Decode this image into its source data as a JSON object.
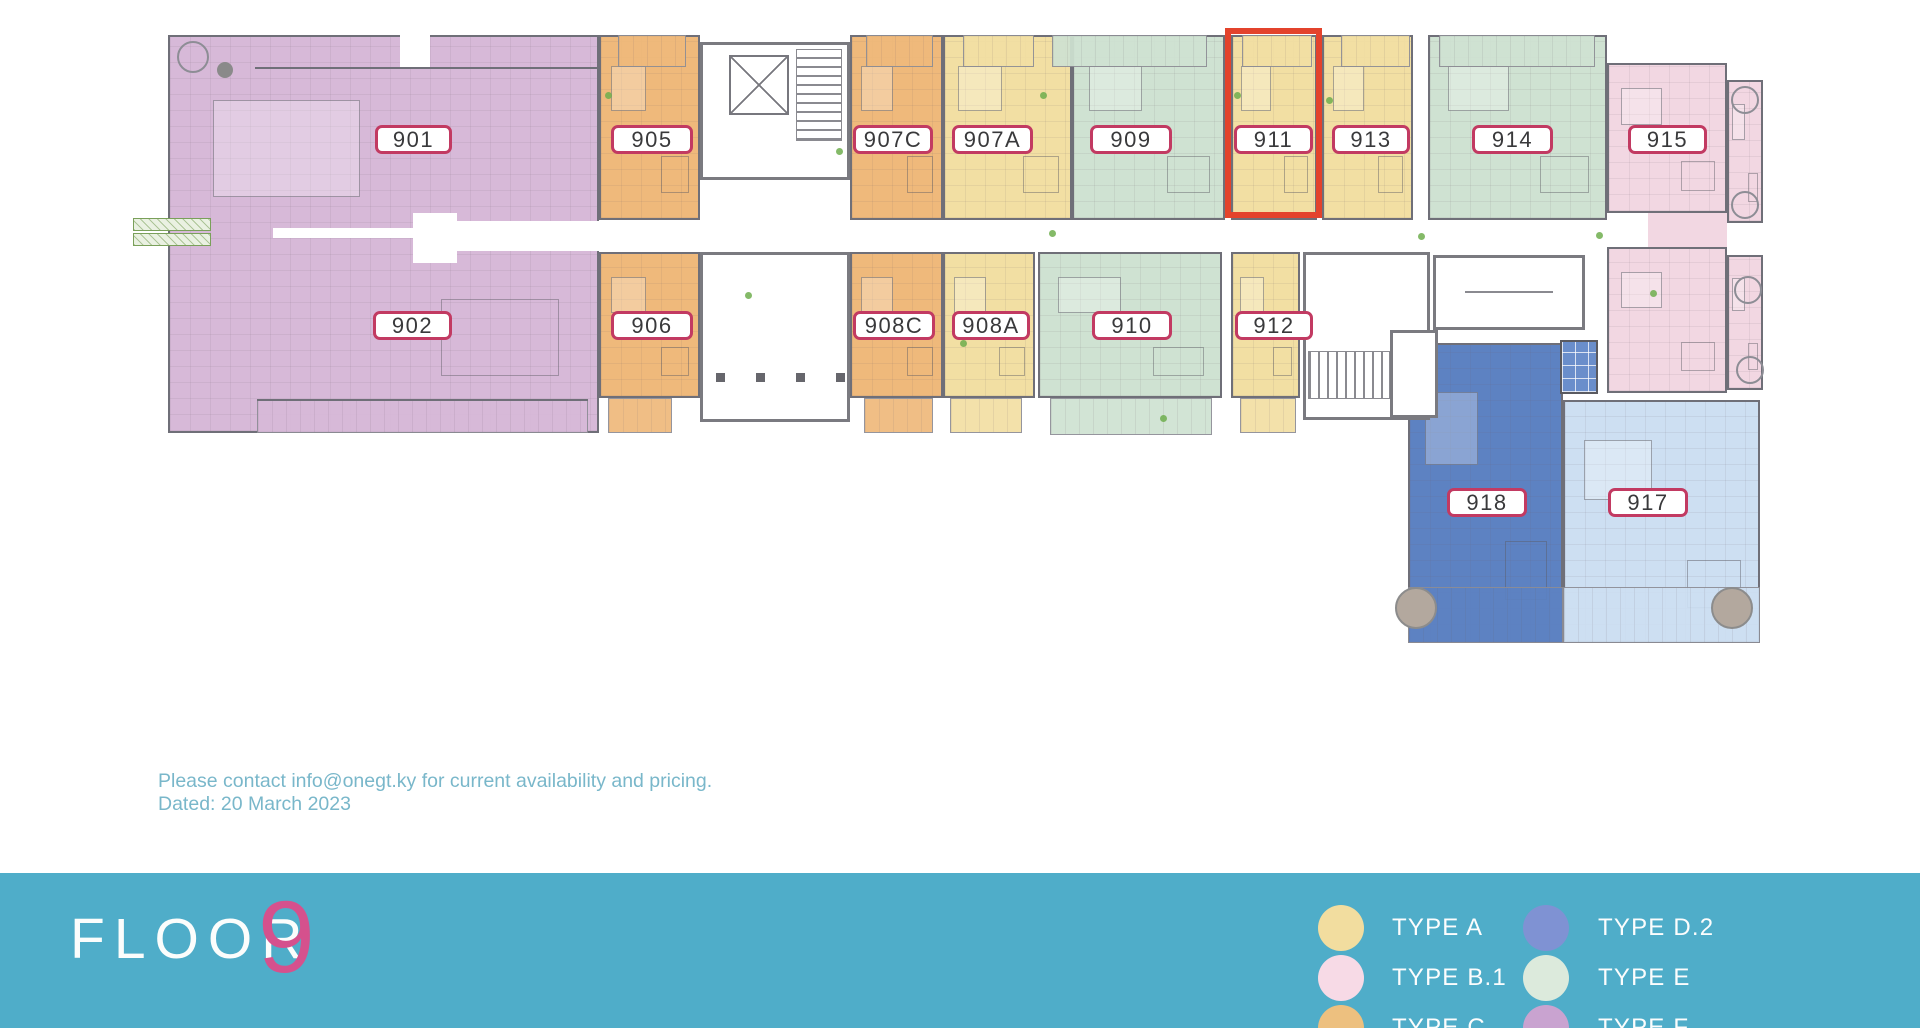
{
  "page": {
    "width": 1920,
    "height": 1028
  },
  "colors": {
    "purple": "#d7b9d8",
    "orange": "#efb97b",
    "yellow": "#f2dfa3",
    "mint": "#cfe2d2",
    "pink": "#f2d7e2",
    "blue": "#5d82c2",
    "lightblue": "#cddff2",
    "white": "#ffffff",
    "highlight_red": "#e3432c",
    "label_border": "#c23a62",
    "label_text": "#39393b",
    "footer_teal": "#4fadc9",
    "notice_teal": "#79b7ca",
    "logo_pink": "#d5518d"
  },
  "plan": {
    "highlighted_unit": "911",
    "units": [
      {
        "id": "901-902",
        "color": "purple",
        "x": 168,
        "y": 35,
        "w": 431,
        "h": 398
      },
      {
        "id": "905",
        "color": "orange",
        "x": 599,
        "y": 35,
        "w": 101,
        "h": 185
      },
      {
        "id": "907C",
        "color": "orange",
        "x": 850,
        "y": 35,
        "w": 93,
        "h": 185
      },
      {
        "id": "907A",
        "color": "yellow",
        "x": 943,
        "y": 35,
        "w": 129,
        "h": 185
      },
      {
        "id": "909",
        "color": "mint",
        "x": 1072,
        "y": 35,
        "w": 153,
        "h": 185
      },
      {
        "id": "911",
        "color": "yellow",
        "x": 1231,
        "y": 35,
        "w": 86,
        "h": 185
      },
      {
        "id": "913",
        "color": "yellow",
        "x": 1322,
        "y": 35,
        "w": 91,
        "h": 185
      },
      {
        "id": "914",
        "color": "mint",
        "x": 1428,
        "y": 35,
        "w": 179,
        "h": 185
      },
      {
        "id": "915",
        "color": "pink",
        "x": 1607,
        "y": 63,
        "w": 120,
        "h": 150
      },
      {
        "id": "915-balcony",
        "color": "pink",
        "x": 1727,
        "y": 80,
        "w": 36,
        "h": 143
      },
      {
        "id": "906",
        "color": "orange",
        "x": 599,
        "y": 252,
        "w": 101,
        "h": 146
      },
      {
        "id": "908C",
        "color": "orange",
        "x": 850,
        "y": 252,
        "w": 93,
        "h": 146
      },
      {
        "id": "908A",
        "color": "yellow",
        "x": 943,
        "y": 252,
        "w": 92,
        "h": 146
      },
      {
        "id": "910",
        "color": "mint",
        "x": 1038,
        "y": 252,
        "w": 184,
        "h": 146
      },
      {
        "id": "912",
        "color": "yellow",
        "x": 1231,
        "y": 252,
        "w": 69,
        "h": 146
      },
      {
        "id": "916",
        "color": "pink",
        "x": 1607,
        "y": 247,
        "w": 120,
        "h": 146
      },
      {
        "id": "916-balcony",
        "color": "pink",
        "x": 1727,
        "y": 255,
        "w": 36,
        "h": 135
      },
      {
        "id": "918",
        "color": "blue",
        "x": 1408,
        "y": 343,
        "w": 155,
        "h": 300
      },
      {
        "id": "917",
        "color": "lightblue",
        "x": 1563,
        "y": 400,
        "w": 197,
        "h": 243
      }
    ],
    "balconies": [
      {
        "of": "905",
        "color": "orange",
        "x": 618,
        "y": 35,
        "w": 68,
        "h": 32
      },
      {
        "of": "907C",
        "color": "orange",
        "x": 866,
        "y": 35,
        "w": 67,
        "h": 32
      },
      {
        "of": "907A",
        "color": "yellow",
        "x": 963,
        "y": 35,
        "w": 71,
        "h": 32
      },
      {
        "of": "909",
        "color": "mint",
        "x": 1052,
        "y": 35,
        "w": 155,
        "h": 32
      },
      {
        "of": "911",
        "color": "yellow",
        "x": 1242,
        "y": 35,
        "w": 70,
        "h": 32
      },
      {
        "of": "913",
        "color": "yellow",
        "x": 1341,
        "y": 35,
        "w": 69,
        "h": 32
      },
      {
        "of": "914",
        "color": "mint",
        "x": 1439,
        "y": 35,
        "w": 156,
        "h": 32
      },
      {
        "of": "902",
        "color": "purple",
        "x": 257,
        "y": 400,
        "w": 331,
        "h": 33
      },
      {
        "of": "906",
        "color": "orange",
        "x": 608,
        "y": 398,
        "w": 64,
        "h": 35
      },
      {
        "of": "908C",
        "color": "orange",
        "x": 864,
        "y": 398,
        "w": 69,
        "h": 35
      },
      {
        "of": "908A",
        "color": "yellow",
        "x": 950,
        "y": 398,
        "w": 72,
        "h": 35
      },
      {
        "of": "910",
        "color": "mint",
        "x": 1050,
        "y": 398,
        "w": 162,
        "h": 37
      },
      {
        "of": "912",
        "color": "yellow",
        "x": 1240,
        "y": 398,
        "w": 56,
        "h": 35
      },
      {
        "of": "917-918",
        "color": "blue",
        "x": 1408,
        "y": 587,
        "w": 155,
        "h": 56
      },
      {
        "of": "917",
        "color": "lightblue",
        "x": 1563,
        "y": 587,
        "w": 197,
        "h": 56
      }
    ],
    "corridor": [
      {
        "x": 273,
        "y": 228,
        "w": 140,
        "h": 10,
        "color": "white"
      },
      {
        "x": 413,
        "y": 213,
        "w": 44,
        "h": 50,
        "color": "white"
      },
      {
        "x": 450,
        "y": 221,
        "w": 149,
        "h": 30,
        "color": "white"
      },
      {
        "x": 400,
        "y": 35,
        "w": 30,
        "h": 33,
        "color": "white"
      },
      {
        "x": 1648,
        "y": 213,
        "w": 79,
        "h": 34,
        "color": "pink"
      }
    ],
    "lines": [
      {
        "x": 255,
        "y": 67,
        "w": 344
      },
      {
        "x": 257,
        "y": 399,
        "w": 331
      }
    ],
    "service_areas": [
      {
        "kind": "stair-elevator-core",
        "x": 700,
        "y": 42,
        "w": 150,
        "h": 138
      },
      {
        "kind": "lobby",
        "x": 700,
        "y": 252,
        "w": 150,
        "h": 170
      },
      {
        "kind": "stairwell",
        "x": 1303,
        "y": 252,
        "w": 127,
        "h": 168
      },
      {
        "kind": "amenity-room",
        "x": 1433,
        "y": 255,
        "w": 152,
        "h": 75
      },
      {
        "kind": "hall",
        "x": 1390,
        "y": 330,
        "w": 48,
        "h": 88
      },
      {
        "kind": "pool",
        "x": 1560,
        "y": 340,
        "w": 38,
        "h": 54
      }
    ],
    "planters": [
      {
        "x": 133,
        "y": 218,
        "w": 78,
        "h": 13
      },
      {
        "x": 133,
        "y": 233,
        "w": 78,
        "h": 13
      }
    ],
    "circles": [
      {
        "x": 193,
        "y": 57,
        "r": 16,
        "stroke": "#8d8d95"
      },
      {
        "x": 225,
        "y": 70,
        "r": 8,
        "fill": "#8a8a8a"
      },
      {
        "x": 1745,
        "y": 100,
        "r": 14,
        "stroke": "#8d8d95"
      },
      {
        "x": 1745,
        "y": 205,
        "r": 14,
        "stroke": "#8d8d95"
      },
      {
        "x": 1748,
        "y": 290,
        "r": 14,
        "stroke": "#8d8d95"
      },
      {
        "x": 1750,
        "y": 370,
        "r": 14,
        "stroke": "#8d8d95"
      },
      {
        "x": 1416,
        "y": 608,
        "r": 21,
        "fill": "#b3a89e",
        "stroke": "#8c8c8c"
      },
      {
        "x": 1732,
        "y": 608,
        "r": 21,
        "fill": "#b3a89e",
        "stroke": "#8c8c8c"
      }
    ],
    "plants": [
      {
        "x": 605,
        "y": 92
      },
      {
        "x": 836,
        "y": 148
      },
      {
        "x": 1040,
        "y": 92
      },
      {
        "x": 1049,
        "y": 230
      },
      {
        "x": 1234,
        "y": 92
      },
      {
        "x": 1326,
        "y": 97
      },
      {
        "x": 1418,
        "y": 233
      },
      {
        "x": 1596,
        "y": 232
      },
      {
        "x": 1650,
        "y": 290
      },
      {
        "x": 1160,
        "y": 415
      },
      {
        "x": 745,
        "y": 292
      },
      {
        "x": 960,
        "y": 340
      }
    ],
    "highlight": {
      "x": 1225,
      "y": 28,
      "w": 97,
      "h": 190
    },
    "labels": [
      {
        "text": "901",
        "x": 375,
        "y": 125,
        "w": 77
      },
      {
        "text": "905",
        "x": 611,
        "y": 125,
        "w": 82
      },
      {
        "text": "907C",
        "x": 853,
        "y": 125,
        "w": 80
      },
      {
        "text": "907A",
        "x": 952,
        "y": 125,
        "w": 81
      },
      {
        "text": "909",
        "x": 1090,
        "y": 125,
        "w": 82
      },
      {
        "text": "911",
        "x": 1234,
        "y": 125,
        "w": 79
      },
      {
        "text": "913",
        "x": 1332,
        "y": 125,
        "w": 78
      },
      {
        "text": "914",
        "x": 1472,
        "y": 125,
        "w": 81
      },
      {
        "text": "915",
        "x": 1628,
        "y": 125,
        "w": 79
      },
      {
        "text": "902",
        "x": 373,
        "y": 311,
        "w": 79
      },
      {
        "text": "906",
        "x": 611,
        "y": 311,
        "w": 82
      },
      {
        "text": "908C",
        "x": 853,
        "y": 311,
        "w": 82
      },
      {
        "text": "908A",
        "x": 952,
        "y": 311,
        "w": 78
      },
      {
        "text": "910",
        "x": 1092,
        "y": 311,
        "w": 80
      },
      {
        "text": "912",
        "x": 1235,
        "y": 311,
        "w": 78
      },
      {
        "text": "918",
        "x": 1447,
        "y": 488,
        "w": 80
      },
      {
        "text": "917",
        "x": 1608,
        "y": 488,
        "w": 80
      }
    ]
  },
  "notice": {
    "line1": "Please contact info@onegt.ky for current availability and pricing.",
    "line2": "Dated: 20 March 2023"
  },
  "footer": {
    "logo_floor": "FLOOR",
    "logo_number": "9",
    "legend": [
      {
        "label": "TYPE A",
        "color": "#f2dd9f",
        "col": 0,
        "row": 0
      },
      {
        "label": "TYPE B.1",
        "color": "#f7dae6",
        "col": 0,
        "row": 1
      },
      {
        "label": "TYPE C",
        "color": "#edc07f",
        "col": 0,
        "row": 2
      },
      {
        "label": "TYPE D.2",
        "color": "#7f92d3",
        "col": 1,
        "row": 0
      },
      {
        "label": "TYPE E",
        "color": "#dceadc",
        "col": 1,
        "row": 1
      },
      {
        "label": "TYPE F",
        "color": "#c9a3d0",
        "col": 1,
        "row": 2
      }
    ]
  }
}
